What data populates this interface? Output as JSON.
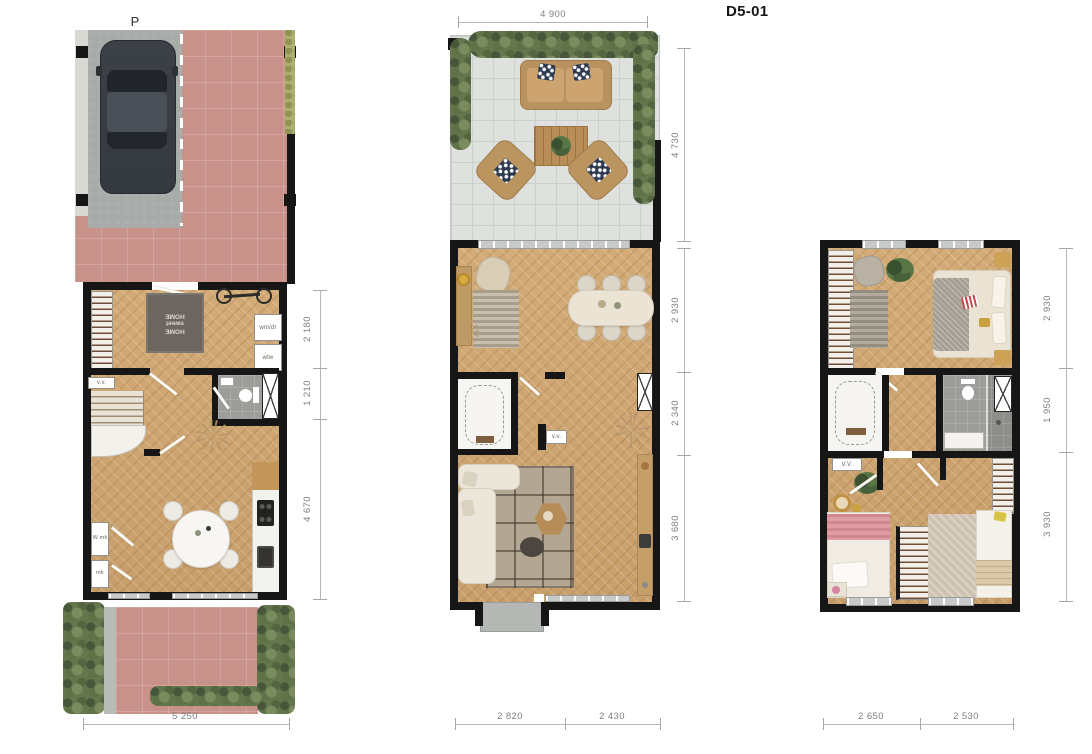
{
  "title": "D5-01",
  "ground_floor": {
    "parking_label": "P",
    "doormat": "HOME sweet HOME",
    "labels": {
      "wmdr": "wm/dr",
      "wtw": "wtw",
      "vv": "v.v.",
      "wmk": "W mk",
      "mk": "mk"
    },
    "dims_right": [
      "2 180",
      "1 210",
      "4 670"
    ],
    "dim_bottom": "5 250"
  },
  "first_floor": {
    "dim_top": "4 900",
    "labels": {
      "vv": "v.v."
    },
    "dims_right": [
      "4 730",
      "2 930",
      "2 340",
      "3 680"
    ],
    "dims_bottom": [
      "2 820",
      "2 430"
    ]
  },
  "second_floor": {
    "labels": {
      "vv": "V.V."
    },
    "dims_right": [
      "2 930",
      "1 950",
      "3 930"
    ],
    "dims_bottom": [
      "2 650",
      "2 530"
    ]
  }
}
